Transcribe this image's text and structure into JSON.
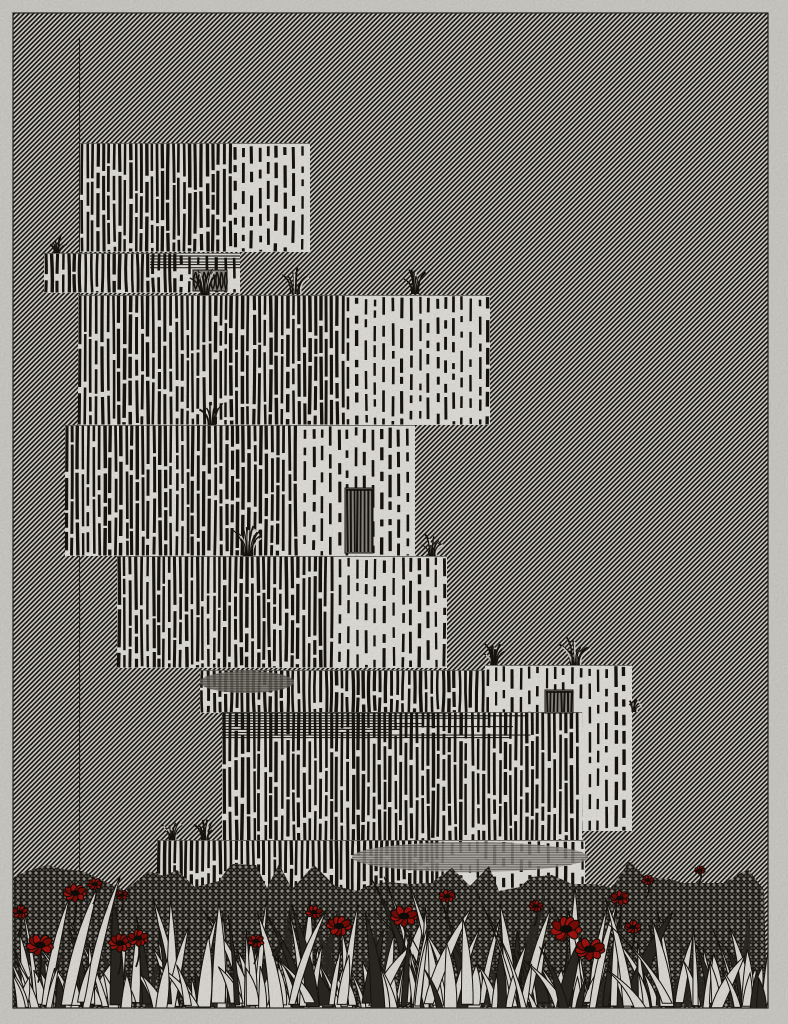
{
  "label": "Generative plotter artwork: stacked hatched blocks above a meadow of grass blades and red poppies",
  "canvas": {
    "width": 788,
    "height": 1024
  },
  "frame": {
    "x": 13,
    "y": 13,
    "width": 755,
    "height": 995
  },
  "palette": {
    "paper": "#d4d2cd",
    "art_bg": "#dedcd6",
    "ink": "#171410",
    "block_light": "#e9e7e0",
    "gray_shadow": "#7b786f",
    "light_gray_shadow": "#a7a49c",
    "window_fill": "#8f8c85",
    "blade_light": "#e4e2db",
    "blade_dark": "#2c2923",
    "grass_base": "#999690",
    "grass_hatch": "#1d1a15",
    "poppy_red": "#a41410",
    "poppy_red_dark": "#7c0d08",
    "poppy_center": "#100d09"
  },
  "background": {
    "hatch_direction": "/",
    "period": 4.7,
    "line_width": 1.6
  },
  "antenna_line": {
    "x": 79.5,
    "y1": 38,
    "y2": 876
  },
  "blocks": [
    {
      "id": "block-a",
      "x": 80,
      "y": 143,
      "w": 230,
      "h": 109,
      "dense_w": 152
    },
    {
      "id": "strip-b",
      "x": 44,
      "y": 253,
      "w": 196,
      "h": 40,
      "dense_w": 134
    },
    {
      "id": "block-c",
      "x": 78,
      "y": 295,
      "w": 412,
      "h": 130,
      "dense_w": 267
    },
    {
      "id": "block-d",
      "x": 65,
      "y": 425,
      "w": 350,
      "h": 131,
      "dense_w": 237
    },
    {
      "id": "block-e",
      "x": 117,
      "y": 556,
      "w": 330,
      "h": 112,
      "dense_w": 220
    },
    {
      "id": "strip-f",
      "x": 200,
      "y": 670,
      "w": 287,
      "h": 43,
      "dense_w": 287
    },
    {
      "id": "column-h",
      "x": 485,
      "y": 665,
      "w": 147,
      "h": 166,
      "dense_w": 0
    },
    {
      "id": "block-g",
      "x": 222,
      "y": 712,
      "w": 360,
      "h": 130,
      "dense_w": 360
    },
    {
      "id": "strip-i",
      "x": 157,
      "y": 840,
      "w": 428,
      "h": 66,
      "dense_w": 283
    }
  ],
  "windows": [
    {
      "x": 193,
      "y": 270,
      "w": 34,
      "h": 21,
      "style": "scribble"
    },
    {
      "x": 345,
      "y": 488,
      "w": 28,
      "h": 65,
      "style": "striped"
    },
    {
      "x": 545,
      "y": 690,
      "w": 28,
      "h": 23,
      "style": "striped"
    }
  ],
  "shadows": [
    {
      "type": "band",
      "x": 150,
      "y": 255,
      "w": 90,
      "h": 13,
      "fade": false
    },
    {
      "type": "band",
      "x": 222,
      "y": 712,
      "w": 360,
      "h": 26,
      "fade": true
    },
    {
      "type": "ellipse",
      "cx": 247,
      "cy": 682,
      "rx": 47,
      "ry": 11,
      "tone": "gray"
    },
    {
      "type": "ellipse",
      "cx": 470,
      "cy": 857,
      "rx": 118,
      "ry": 15,
      "tone": "lightgray"
    }
  ],
  "tufts": [
    {
      "x": 57,
      "y": 253,
      "size": 15
    },
    {
      "x": 205,
      "y": 295,
      "size": 22
    },
    {
      "x": 295,
      "y": 294,
      "size": 26
    },
    {
      "x": 415,
      "y": 294,
      "size": 20
    },
    {
      "x": 212,
      "y": 425,
      "size": 20
    },
    {
      "x": 248,
      "y": 556,
      "size": 26
    },
    {
      "x": 432,
      "y": 556,
      "size": 18
    },
    {
      "x": 494,
      "y": 665,
      "size": 18
    },
    {
      "x": 575,
      "y": 665,
      "size": 24
    },
    {
      "x": 172,
      "y": 840,
      "size": 16
    },
    {
      "x": 205,
      "y": 840,
      "size": 18
    },
    {
      "x": 634,
      "y": 712,
      "size": 10
    }
  ],
  "grass": {
    "left": 14,
    "right": 767,
    "bottom": 1007,
    "top_min": 846,
    "base_top": 872,
    "back_blade_count": 65,
    "blade_count": 215,
    "front_blade_count": 22,
    "seed": 1337
  },
  "poppies": [
    {
      "x": 20,
      "y": 912,
      "r": 8
    },
    {
      "x": 75,
      "y": 893,
      "r": 11
    },
    {
      "x": 95,
      "y": 884,
      "r": 7
    },
    {
      "x": 122,
      "y": 895,
      "r": 6
    },
    {
      "x": 40,
      "y": 945,
      "r": 13
    },
    {
      "x": 120,
      "y": 943,
      "r": 11
    },
    {
      "x": 138,
      "y": 938,
      "r": 10
    },
    {
      "x": 256,
      "y": 941,
      "r": 8
    },
    {
      "x": 314,
      "y": 912,
      "r": 8
    },
    {
      "x": 339,
      "y": 926,
      "r": 12
    },
    {
      "x": 404,
      "y": 916,
      "r": 13
    },
    {
      "x": 447,
      "y": 896,
      "r": 8
    },
    {
      "x": 536,
      "y": 906,
      "r": 7
    },
    {
      "x": 566,
      "y": 929,
      "r": 15
    },
    {
      "x": 590,
      "y": 949,
      "r": 14
    },
    {
      "x": 620,
      "y": 898,
      "r": 9
    },
    {
      "x": 633,
      "y": 927,
      "r": 8
    },
    {
      "x": 648,
      "y": 880,
      "r": 6
    },
    {
      "x": 700,
      "y": 870,
      "r": 5
    }
  ]
}
